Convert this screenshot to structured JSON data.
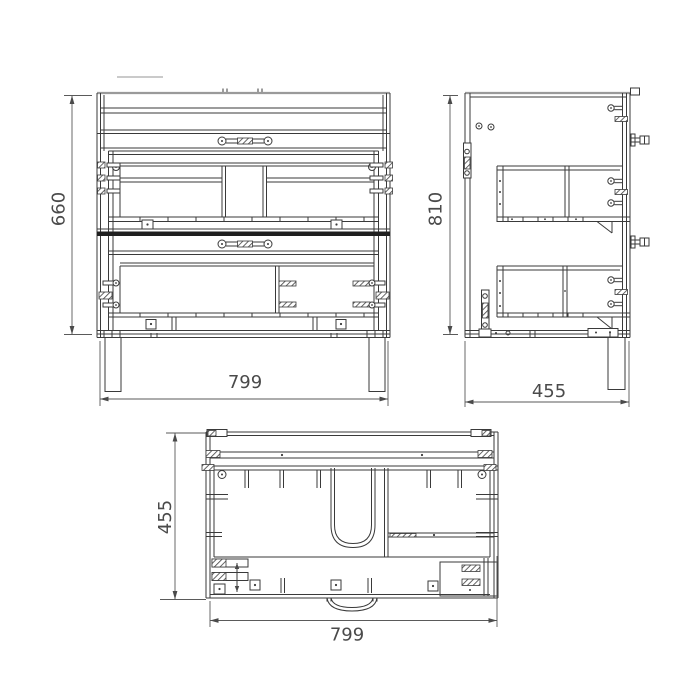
{
  "drawing": {
    "type": "technical-drawing-three-views",
    "dimensions": {
      "front_height": "660",
      "front_width": "799",
      "side_height": "810",
      "side_depth": "455",
      "top_depth": "455",
      "top_width": "799"
    },
    "colors": {
      "background": "#ffffff",
      "line": "#3a3a3a",
      "edge_gray": "#9a9a9a",
      "dimension_text": "#4a4a4a"
    }
  }
}
